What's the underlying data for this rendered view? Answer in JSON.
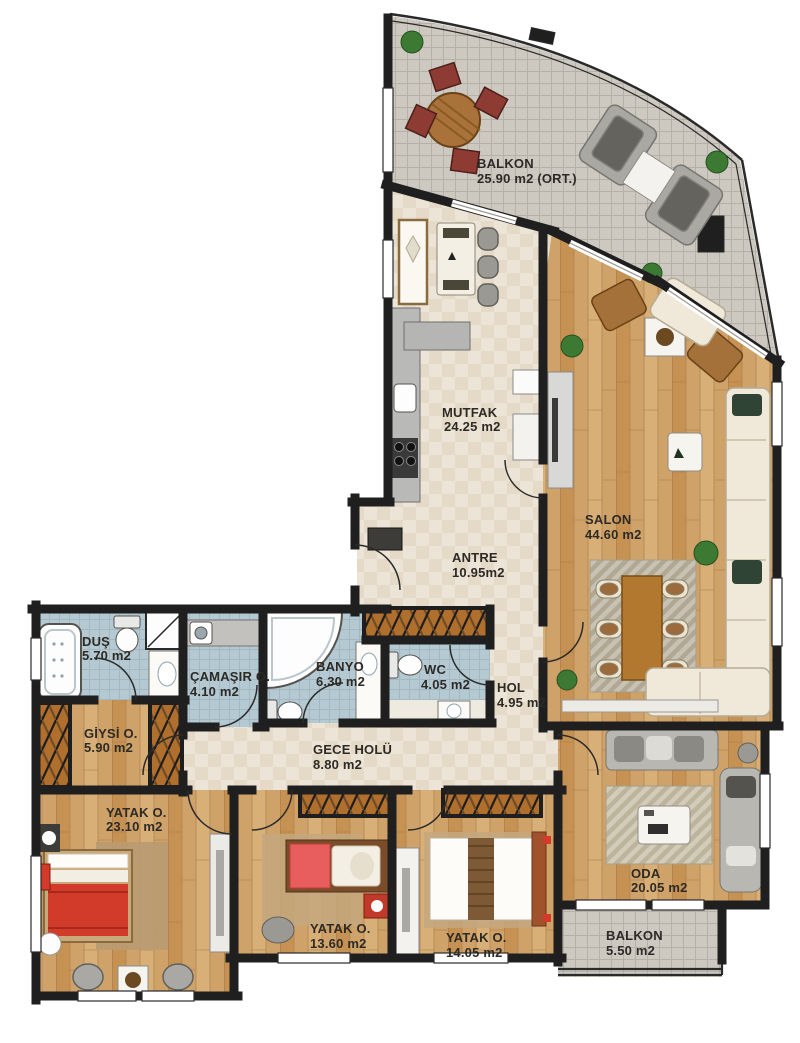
{
  "plan_title": "Apartment floor plan",
  "rooms": [
    {
      "name": "BALKON",
      "area": "25.90 m2 (ORT.)"
    },
    {
      "name": "MUTFAK",
      "area": "24.25 m2"
    },
    {
      "name": "SALON",
      "area": "44.60 m2"
    },
    {
      "name": "ANTRE",
      "area": "10.95m2"
    },
    {
      "name": "DUŞ",
      "area": "5.70 m2"
    },
    {
      "name": "ÇAMAŞIR O.",
      "area": "4.10 m2"
    },
    {
      "name": "BANYO",
      "area": "6.30 m2"
    },
    {
      "name": "WC",
      "area": "4.05 m2"
    },
    {
      "name": "HOL",
      "area": "4.95 m2"
    },
    {
      "name": "GİYSİ O.",
      "area": "5.90 m2"
    },
    {
      "name": "GECE HOLÜ",
      "area": "8.80 m2"
    },
    {
      "name": "YATAK O.",
      "area": "23.10 m2"
    },
    {
      "name": "YATAK O.",
      "area": "13.60 m2"
    },
    {
      "name": "YATAK O.",
      "area": "14.05 m2"
    },
    {
      "name": "ODA",
      "area": "20.05 m2"
    },
    {
      "name": "BALKON",
      "area": "5.50 m2"
    }
  ],
  "colors": {
    "wall": "#1f1f1f",
    "wood_floor": "#cfa26a",
    "tile_beige": "#ebe3d4",
    "tile_blue": "#b4c9d1",
    "tile_gray": "#cdc9c1",
    "label_text": "#2d2a26",
    "accent_red": "#d23b2a",
    "sofa_cream": "#f0e9da",
    "furniture_gray": "#a9a8a4",
    "wardrobe_brown": "#b06f2c"
  }
}
